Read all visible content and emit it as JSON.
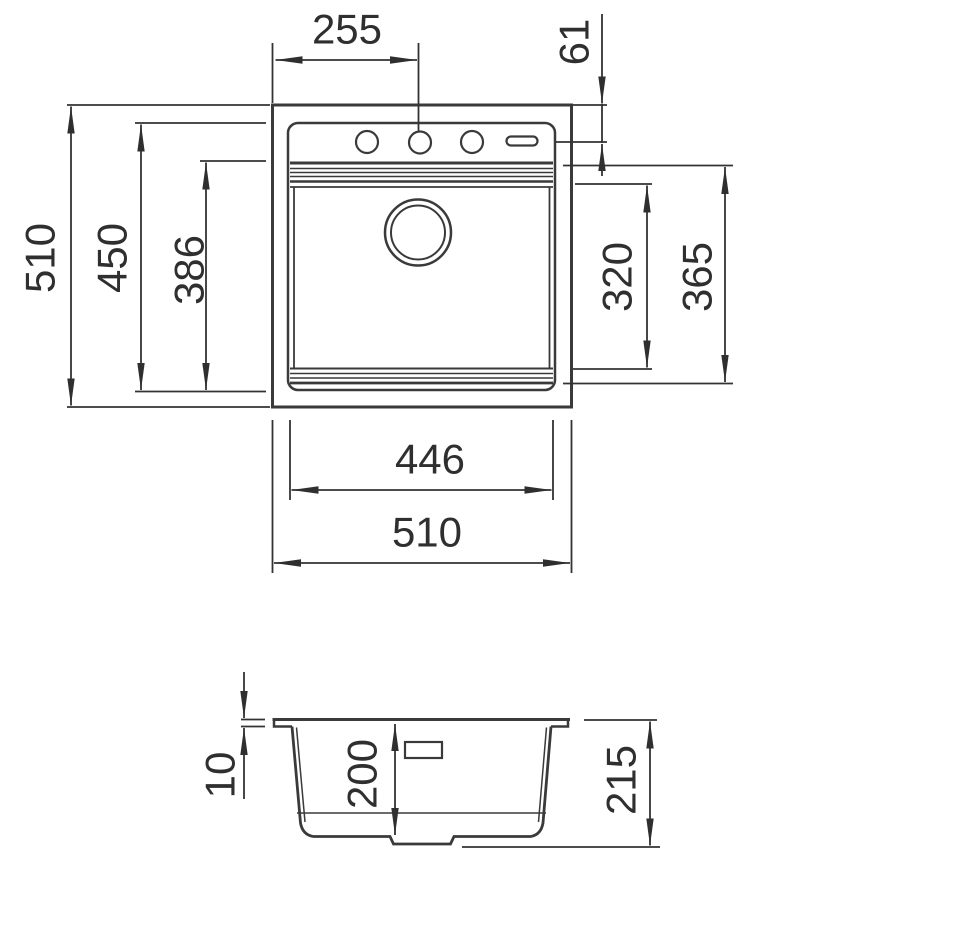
{
  "dimensions": {
    "plan": {
      "edge_to_tap_centre": "255",
      "tap_centre_offset": "61",
      "overall_depth": "510",
      "rim_inner_depth": "450",
      "bowl_depth_outer": "386",
      "bowl_inner": "320",
      "bowl_outer": "365",
      "rim_inner_width": "446",
      "overall_width": "510"
    },
    "section": {
      "rim_height": "10",
      "bowl_depth": "200",
      "overall_height": "215"
    }
  }
}
